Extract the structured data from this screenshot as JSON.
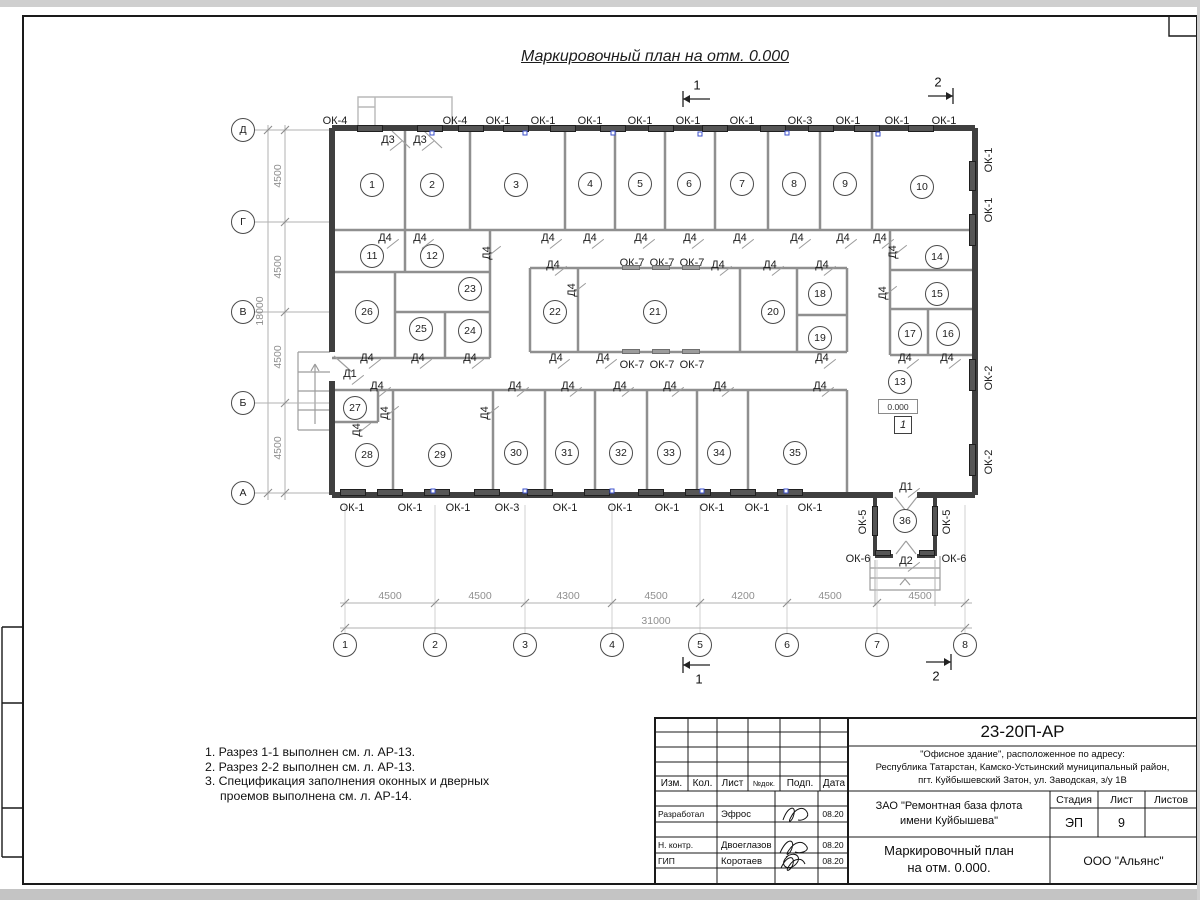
{
  "sheet": {
    "title": "Маркировочный план на отм. 0.000",
    "elevation_mark": "0.000",
    "floor_mark": "1"
  },
  "notes": {
    "lines": [
      "1. Разрез 1-1 выполнен см. л. АР-13.",
      "2. Разрез 2-2 выполнен см. л. АР-13.",
      "3. Спецификация заполнения оконных и дверных",
      "проемов выполнена см. л. АР-14."
    ]
  },
  "colors": {
    "outer_wall": "#3f3f3f",
    "partition": "#8f8f8f",
    "window_bar": "#565656",
    "dim_text": "#8f8f8f",
    "vent_mark": "#3c52cc"
  },
  "plan": {
    "rooms": [
      {
        "n": "1",
        "x": 372,
        "y": 185
      },
      {
        "n": "2",
        "x": 432,
        "y": 185
      },
      {
        "n": "3",
        "x": 516,
        "y": 185
      },
      {
        "n": "4",
        "x": 590,
        "y": 184
      },
      {
        "n": "5",
        "x": 640,
        "y": 184
      },
      {
        "n": "6",
        "x": 689,
        "y": 184
      },
      {
        "n": "7",
        "x": 742,
        "y": 184
      },
      {
        "n": "8",
        "x": 794,
        "y": 184
      },
      {
        "n": "9",
        "x": 845,
        "y": 184
      },
      {
        "n": "10",
        "x": 922,
        "y": 187
      },
      {
        "n": "11",
        "x": 372,
        "y": 256
      },
      {
        "n": "12",
        "x": 432,
        "y": 256
      },
      {
        "n": "23",
        "x": 470,
        "y": 289
      },
      {
        "n": "26",
        "x": 367,
        "y": 312
      },
      {
        "n": "25",
        "x": 421,
        "y": 329
      },
      {
        "n": "24",
        "x": 470,
        "y": 331
      },
      {
        "n": "22",
        "x": 555,
        "y": 312
      },
      {
        "n": "21",
        "x": 655,
        "y": 312
      },
      {
        "n": "20",
        "x": 773,
        "y": 312
      },
      {
        "n": "18",
        "x": 820,
        "y": 294
      },
      {
        "n": "19",
        "x": 820,
        "y": 338
      },
      {
        "n": "14",
        "x": 937,
        "y": 257
      },
      {
        "n": "15",
        "x": 937,
        "y": 294
      },
      {
        "n": "17",
        "x": 910,
        "y": 334
      },
      {
        "n": "16",
        "x": 948,
        "y": 334
      },
      {
        "n": "13",
        "x": 900,
        "y": 382
      },
      {
        "n": "27",
        "x": 355,
        "y": 408
      },
      {
        "n": "28",
        "x": 367,
        "y": 455
      },
      {
        "n": "29",
        "x": 440,
        "y": 455
      },
      {
        "n": "30",
        "x": 516,
        "y": 453
      },
      {
        "n": "31",
        "x": 567,
        "y": 453
      },
      {
        "n": "32",
        "x": 621,
        "y": 453
      },
      {
        "n": "33",
        "x": 669,
        "y": 453
      },
      {
        "n": "34",
        "x": 719,
        "y": 453
      },
      {
        "n": "35",
        "x": 795,
        "y": 453
      },
      {
        "n": "36",
        "x": 905,
        "y": 521
      }
    ],
    "axis_rows": [
      {
        "t": "Д",
        "x": 243,
        "y": 130
      },
      {
        "t": "Г",
        "x": 243,
        "y": 222
      },
      {
        "t": "В",
        "x": 243,
        "y": 312
      },
      {
        "t": "Б",
        "x": 243,
        "y": 403
      },
      {
        "t": "А",
        "x": 243,
        "y": 493
      }
    ],
    "axis_cols": [
      {
        "t": "1",
        "x": 345,
        "y": 645
      },
      {
        "t": "2",
        "x": 435,
        "y": 645
      },
      {
        "t": "3",
        "x": 525,
        "y": 645
      },
      {
        "t": "4",
        "x": 612,
        "y": 645
      },
      {
        "t": "5",
        "x": 700,
        "y": 645
      },
      {
        "t": "6",
        "x": 787,
        "y": 645
      },
      {
        "t": "7",
        "x": 877,
        "y": 645
      },
      {
        "t": "8",
        "x": 965,
        "y": 645
      }
    ],
    "windows": [
      {
        "t": "ОК-4",
        "x": 335,
        "y": 121,
        "bar": [
          357,
          125,
          26,
          7
        ]
      },
      {
        "t": "ОК-4",
        "x": 455,
        "y": 121,
        "bar": [
          417,
          125,
          26,
          7
        ]
      },
      {
        "t": "ОК-1",
        "x": 498,
        "y": 121,
        "bar": [
          458,
          125,
          26,
          7
        ]
      },
      {
        "t": "ОК-1",
        "x": 543,
        "y": 121,
        "bar": [
          503,
          125,
          26,
          7
        ]
      },
      {
        "t": "ОК-1",
        "x": 590,
        "y": 121,
        "bar": [
          550,
          125,
          26,
          7
        ]
      },
      {
        "t": "ОК-1",
        "x": 640,
        "y": 121,
        "bar": [
          600,
          125,
          26,
          7
        ]
      },
      {
        "t": "ОК-1",
        "x": 688,
        "y": 121,
        "bar": [
          648,
          125,
          26,
          7
        ]
      },
      {
        "t": "ОК-1",
        "x": 742,
        "y": 121,
        "bar": [
          702,
          125,
          26,
          7
        ]
      },
      {
        "t": "ОК-3",
        "x": 800,
        "y": 121,
        "bar": [
          760,
          125,
          26,
          7
        ]
      },
      {
        "t": "ОК-1",
        "x": 848,
        "y": 121,
        "bar": [
          808,
          125,
          26,
          7
        ]
      },
      {
        "t": "ОК-1",
        "x": 897,
        "y": 121,
        "bar": [
          854,
          125,
          26,
          7
        ]
      },
      {
        "t": "ОК-1",
        "x": 944,
        "y": 121,
        "bar": [
          908,
          125,
          26,
          7
        ]
      },
      {
        "t": "ОК-1",
        "x": 352,
        "y": 508,
        "bar": [
          340,
          489,
          26,
          7
        ]
      },
      {
        "t": "ОК-1",
        "x": 410,
        "y": 508,
        "bar": [
          377,
          489,
          26,
          7
        ]
      },
      {
        "t": "ОК-1",
        "x": 458,
        "y": 508,
        "bar": [
          424,
          489,
          26,
          7
        ]
      },
      {
        "t": "ОК-3",
        "x": 507,
        "y": 508,
        "bar": [
          474,
          489,
          26,
          7
        ]
      },
      {
        "t": "ОК-1",
        "x": 565,
        "y": 508,
        "bar": [
          527,
          489,
          26,
          7
        ]
      },
      {
        "t": "ОК-1",
        "x": 620,
        "y": 508,
        "bar": [
          584,
          489,
          26,
          7
        ]
      },
      {
        "t": "ОК-1",
        "x": 667,
        "y": 508,
        "bar": [
          638,
          489,
          26,
          7
        ]
      },
      {
        "t": "ОК-1",
        "x": 712,
        "y": 508,
        "bar": [
          685,
          489,
          26,
          7
        ]
      },
      {
        "t": "ОК-1",
        "x": 757,
        "y": 508,
        "bar": [
          730,
          489,
          26,
          7
        ]
      },
      {
        "t": "ОК-1",
        "x": 810,
        "y": 508,
        "bar": [
          777,
          489,
          26,
          7
        ]
      },
      {
        "t": "ОК-1",
        "x": 989,
        "y": 160,
        "rot": true,
        "bar": [
          969,
          161,
          7,
          30
        ]
      },
      {
        "t": "ОК-1",
        "x": 989,
        "y": 210,
        "rot": true,
        "bar": [
          969,
          214,
          7,
          32
        ]
      },
      {
        "t": "ОК-2",
        "x": 989,
        "y": 378,
        "rot": true,
        "bar": [
          969,
          359,
          7,
          32
        ]
      },
      {
        "t": "ОК-2",
        "x": 989,
        "y": 462,
        "rot": true,
        "bar": [
          969,
          444,
          7,
          32
        ]
      },
      {
        "t": "ОК-7",
        "x": 632,
        "y": 263,
        "bar": [
          622,
          265,
          18,
          5
        ]
      },
      {
        "t": "ОК-7",
        "x": 662,
        "y": 263,
        "bar": [
          652,
          265,
          18,
          5
        ]
      },
      {
        "t": "ОК-7",
        "x": 692,
        "y": 263,
        "bar": [
          682,
          265,
          18,
          5
        ]
      },
      {
        "t": "ОК-7",
        "x": 632,
        "y": 365,
        "bar": [
          622,
          349,
          18,
          5
        ]
      },
      {
        "t": "ОК-7",
        "x": 662,
        "y": 365,
        "bar": [
          652,
          349,
          18,
          5
        ]
      },
      {
        "t": "ОК-7",
        "x": 692,
        "y": 365,
        "bar": [
          682,
          349,
          18,
          5
        ]
      },
      {
        "t": "ОК-5",
        "x": 863,
        "y": 522,
        "rot": true,
        "bar": [
          872,
          506,
          6,
          30
        ]
      },
      {
        "t": "ОК-5",
        "x": 947,
        "y": 522,
        "rot": true,
        "bar": [
          932,
          506,
          6,
          30
        ]
      },
      {
        "t": "ОК-6",
        "x": 858,
        "y": 559,
        "bar": [
          875,
          550,
          16,
          6
        ]
      },
      {
        "t": "ОК-6",
        "x": 954,
        "y": 559,
        "bar": [
          919,
          550,
          16,
          6
        ]
      }
    ],
    "doors": [
      {
        "t": "Д3",
        "x": 388,
        "y": 140
      },
      {
        "t": "Д3",
        "x": 420,
        "y": 140
      },
      {
        "t": "Д1",
        "x": 350,
        "y": 374
      },
      {
        "t": "Д1",
        "x": 906,
        "y": 487
      },
      {
        "t": "Д2",
        "x": 906,
        "y": 561
      },
      {
        "t": "Д4",
        "x": 385,
        "y": 238
      },
      {
        "t": "Д4",
        "x": 420,
        "y": 238
      },
      {
        "t": "Д4",
        "x": 548,
        "y": 238
      },
      {
        "t": "Д4",
        "x": 590,
        "y": 238
      },
      {
        "t": "Д4",
        "x": 641,
        "y": 238
      },
      {
        "t": "Д4",
        "x": 690,
        "y": 238
      },
      {
        "t": "Д4",
        "x": 740,
        "y": 238
      },
      {
        "t": "Д4",
        "x": 797,
        "y": 238
      },
      {
        "t": "Д4",
        "x": 843,
        "y": 238
      },
      {
        "t": "Д4",
        "x": 880,
        "y": 238
      },
      {
        "t": "Д4",
        "x": 553,
        "y": 265
      },
      {
        "t": "Д4",
        "x": 718,
        "y": 265
      },
      {
        "t": "Д4",
        "x": 770,
        "y": 265
      },
      {
        "t": "Д4",
        "x": 822,
        "y": 265
      },
      {
        "t": "Д4",
        "x": 487,
        "y": 253,
        "rot": true
      },
      {
        "t": "Д4",
        "x": 572,
        "y": 290,
        "rot": true
      },
      {
        "t": "Д4",
        "x": 893,
        "y": 252,
        "rot": true
      },
      {
        "t": "Д4",
        "x": 883,
        "y": 293,
        "rot": true
      },
      {
        "t": "Д4",
        "x": 357,
        "y": 430,
        "rot": true
      },
      {
        "t": "Д4",
        "x": 385,
        "y": 413,
        "rot": true
      },
      {
        "t": "Д4",
        "x": 485,
        "y": 413,
        "rot": true
      },
      {
        "t": "Д4",
        "x": 367,
        "y": 358
      },
      {
        "t": "Д4",
        "x": 418,
        "y": 358
      },
      {
        "t": "Д4",
        "x": 470,
        "y": 358
      },
      {
        "t": "Д4",
        "x": 556,
        "y": 358
      },
      {
        "t": "Д4",
        "x": 603,
        "y": 358
      },
      {
        "t": "Д4",
        "x": 822,
        "y": 358
      },
      {
        "t": "Д4",
        "x": 905,
        "y": 358
      },
      {
        "t": "Д4",
        "x": 947,
        "y": 358
      },
      {
        "t": "Д4",
        "x": 377,
        "y": 386
      },
      {
        "t": "Д4",
        "x": 515,
        "y": 386
      },
      {
        "t": "Д4",
        "x": 568,
        "y": 386
      },
      {
        "t": "Д4",
        "x": 620,
        "y": 386
      },
      {
        "t": "Д4",
        "x": 670,
        "y": 386
      },
      {
        "t": "Д4",
        "x": 720,
        "y": 386
      },
      {
        "t": "Д4",
        "x": 820,
        "y": 386
      }
    ],
    "dims": [
      {
        "t": "4500",
        "x": 390,
        "y": 596
      },
      {
        "t": "4500",
        "x": 480,
        "y": 596
      },
      {
        "t": "4300",
        "x": 568,
        "y": 596
      },
      {
        "t": "4500",
        "x": 656,
        "y": 596
      },
      {
        "t": "4200",
        "x": 743,
        "y": 596
      },
      {
        "t": "4500",
        "x": 830,
        "y": 596
      },
      {
        "t": "4500",
        "x": 920,
        "y": 596
      },
      {
        "t": "31000",
        "x": 656,
        "y": 621
      },
      {
        "t": "4500",
        "x": 278,
        "y": 176,
        "rot": true
      },
      {
        "t": "4500",
        "x": 278,
        "y": 267,
        "rot": true
      },
      {
        "t": "4500",
        "x": 278,
        "y": 357,
        "rot": true
      },
      {
        "t": "4500",
        "x": 278,
        "y": 448,
        "rot": true
      },
      {
        "t": "18000",
        "x": 260,
        "y": 311,
        "rot": true
      }
    ],
    "sections": [
      {
        "t": "1",
        "x": 697,
        "y": 85
      },
      {
        "t": "2",
        "x": 938,
        "y": 82
      },
      {
        "t": "1",
        "x": 699,
        "y": 679
      },
      {
        "t": "2",
        "x": 936,
        "y": 676
      }
    ],
    "vents": [
      {
        "x": 432,
        "y": 133
      },
      {
        "x": 525,
        "y": 133
      },
      {
        "x": 613,
        "y": 133
      },
      {
        "x": 700,
        "y": 134
      },
      {
        "x": 787,
        "y": 133
      },
      {
        "x": 878,
        "y": 134
      },
      {
        "x": 433,
        "y": 491
      },
      {
        "x": 525,
        "y": 491
      },
      {
        "x": 612,
        "y": 491
      },
      {
        "x": 702,
        "y": 491
      },
      {
        "x": 786,
        "y": 491
      }
    ]
  },
  "title_block": {
    "doc_number": "23-20П-АР",
    "address_line1": "\"Офисное здание\", расположенное по адресу:",
    "address_line2": "Республика Татарстан, Камско-Устьинский муниципальный район,",
    "address_line3": "пгт. Куйбышевский Затон, ул. Заводская, з/у 1В",
    "client_line1": "ЗАО \"Ремонтная база флота",
    "client_line2": "имени Куйбышева\"",
    "stage_label": "Стадия",
    "sheet_label": "Лист",
    "sheets_label": "Листов",
    "stage_value": "ЭП",
    "sheet_value": "9",
    "sheet_title_line1": "Маркировочный план",
    "sheet_title_line2": "на отм. 0.000.",
    "company": "ООО \"Альянс\"",
    "col_izm": "Изм.",
    "col_kol": "Кол.",
    "col_list": "Лист",
    "col_ndok": "№док.",
    "col_podp": "Подп.",
    "col_data": "Дата",
    "row1_role": "Разработал",
    "row1_name": "Эфрос",
    "row1_date": "08.20",
    "row2_role": "Н. контр.",
    "row2_name": "Двоеглазов",
    "row2_date": "08.20",
    "row3_role": "ГИП",
    "row3_name": "Коротаев",
    "row3_date": "08.20"
  }
}
